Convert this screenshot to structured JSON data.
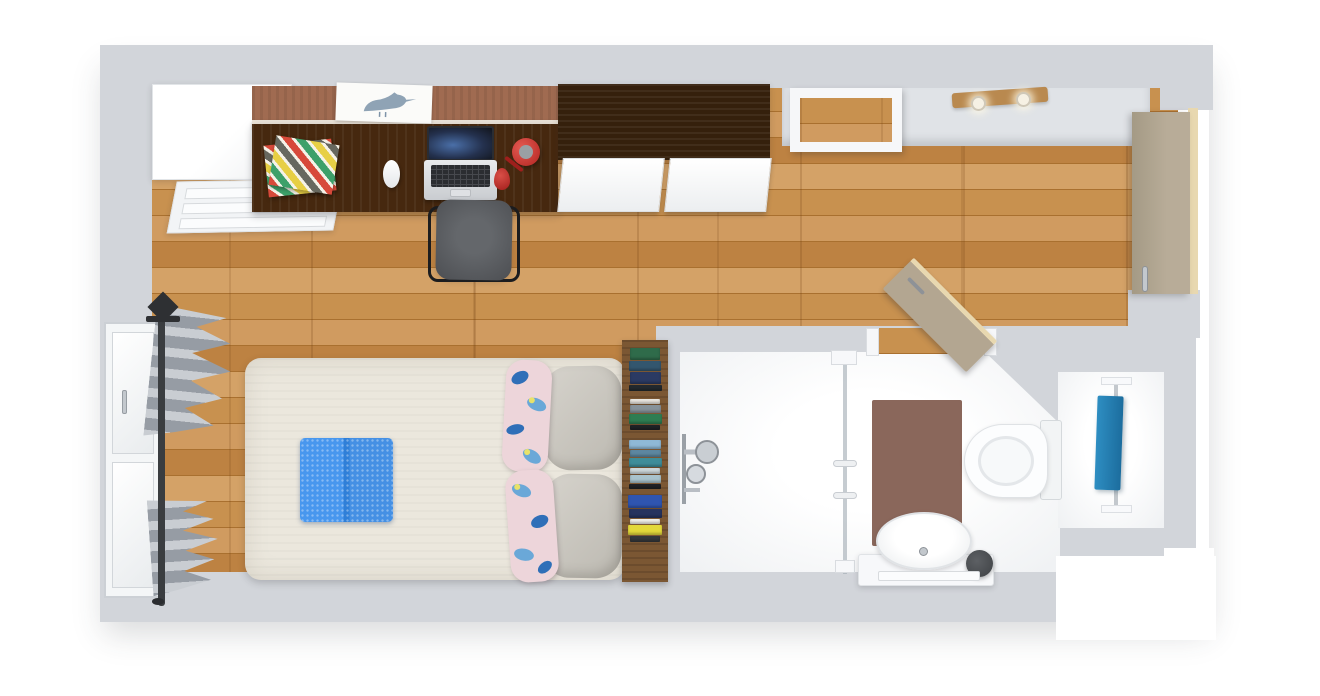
{
  "scene": {
    "title": "Studio apartment 3D floor plan, top-down view",
    "rooms": [
      "main-room",
      "entry",
      "bathroom"
    ]
  },
  "palette": {
    "wall": "#d2d5da",
    "wall-light": "#e0e3e7",
    "floor-base": "#c28a4e",
    "desk-wood": "#46280f",
    "wardrobe-wood": "#35200c",
    "cork": "#a06b51",
    "ledge": "#e9e1d6",
    "door-beige": "#b3a691",
    "door-edge": "#e8d8b0",
    "bed": "#ebe7dd",
    "pillow-gray": "#ccc8bf",
    "pillow-floral": "#edd5da",
    "blanket-blue": "#3e8de9",
    "towel-blue": "#2487bb",
    "mat-brown": "#8a675b",
    "shelf-wood": "#7b5733",
    "chair-gray": "#595c60",
    "chair-frame": "#1c1d1f",
    "lamp-red": "#c6312f",
    "chrome": "#c3c8cd",
    "rod-dark": "#3a3d40",
    "bulb": "#f6f1e4",
    "lightbar-wood": "#b9894f"
  },
  "furniture": {
    "main_room": [
      "white-cabinet",
      "drawer-unit",
      "cork-board",
      "bird-art-print",
      "desk",
      "notebooks",
      "mouse",
      "laptop",
      "desk-lamp",
      "office-chair",
      "dark-wardrobe",
      "open-shelf",
      "ceiling-spotlights",
      "double-bed",
      "gray-pillows",
      "floral-pillows",
      "folded-blanket",
      "bookshelf",
      "window",
      "curtains",
      "curtain-rod",
      "entrance-door",
      "door-stop"
    ],
    "bathroom": [
      "shower-fixture",
      "glass-partition",
      "bathroom-door",
      "bath-mat",
      "washbasin",
      "vanity",
      "faucet",
      "waste-bin",
      "hand-towel",
      "toilet",
      "towel-rail",
      "bath-towel"
    ]
  },
  "bookshelf": {
    "books": [
      {
        "color": "#2f6b4a",
        "h": 12,
        "w": 30,
        "mb": 1
      },
      {
        "color": "#33566e",
        "h": 10,
        "w": 32,
        "mb": 1
      },
      {
        "color": "#2b3a63",
        "h": 12,
        "w": 31,
        "mb": 1
      },
      {
        "color": "#23292e",
        "h": 6,
        "w": 33,
        "mb": 8
      },
      {
        "color": "#e9e6df",
        "h": 5,
        "w": 30,
        "mb": 1
      },
      {
        "color": "#87929a",
        "h": 8,
        "w": 31,
        "mb": 1
      },
      {
        "color": "#2e7d52",
        "h": 10,
        "w": 33,
        "mb": 1
      },
      {
        "color": "#1f2326",
        "h": 5,
        "w": 30,
        "mb": 10
      },
      {
        "color": "#8fb9d6",
        "h": 9,
        "w": 32,
        "mb": 1
      },
      {
        "color": "#5d87a0",
        "h": 7,
        "w": 31,
        "mb": 1
      },
      {
        "color": "#3f8d99",
        "h": 9,
        "w": 33,
        "mb": 1
      },
      {
        "color": "#ccd6d9",
        "h": 6,
        "w": 30,
        "mb": 1
      },
      {
        "color": "#a9c3cc",
        "h": 8,
        "w": 31,
        "mb": 1
      },
      {
        "color": "#202225",
        "h": 5,
        "w": 32,
        "mb": 6
      },
      {
        "color": "#2f55b0",
        "h": 13,
        "w": 34,
        "mb": 1
      },
      {
        "color": "#26335e",
        "h": 9,
        "w": 33,
        "mb": 1
      },
      {
        "color": "#f0efe9",
        "h": 5,
        "w": 30,
        "mb": 1
      },
      {
        "color": "#e3d93b",
        "h": 10,
        "w": 34,
        "mb": 1
      },
      {
        "color": "#35383b",
        "h": 6,
        "w": 30,
        "mb": 0
      }
    ]
  }
}
